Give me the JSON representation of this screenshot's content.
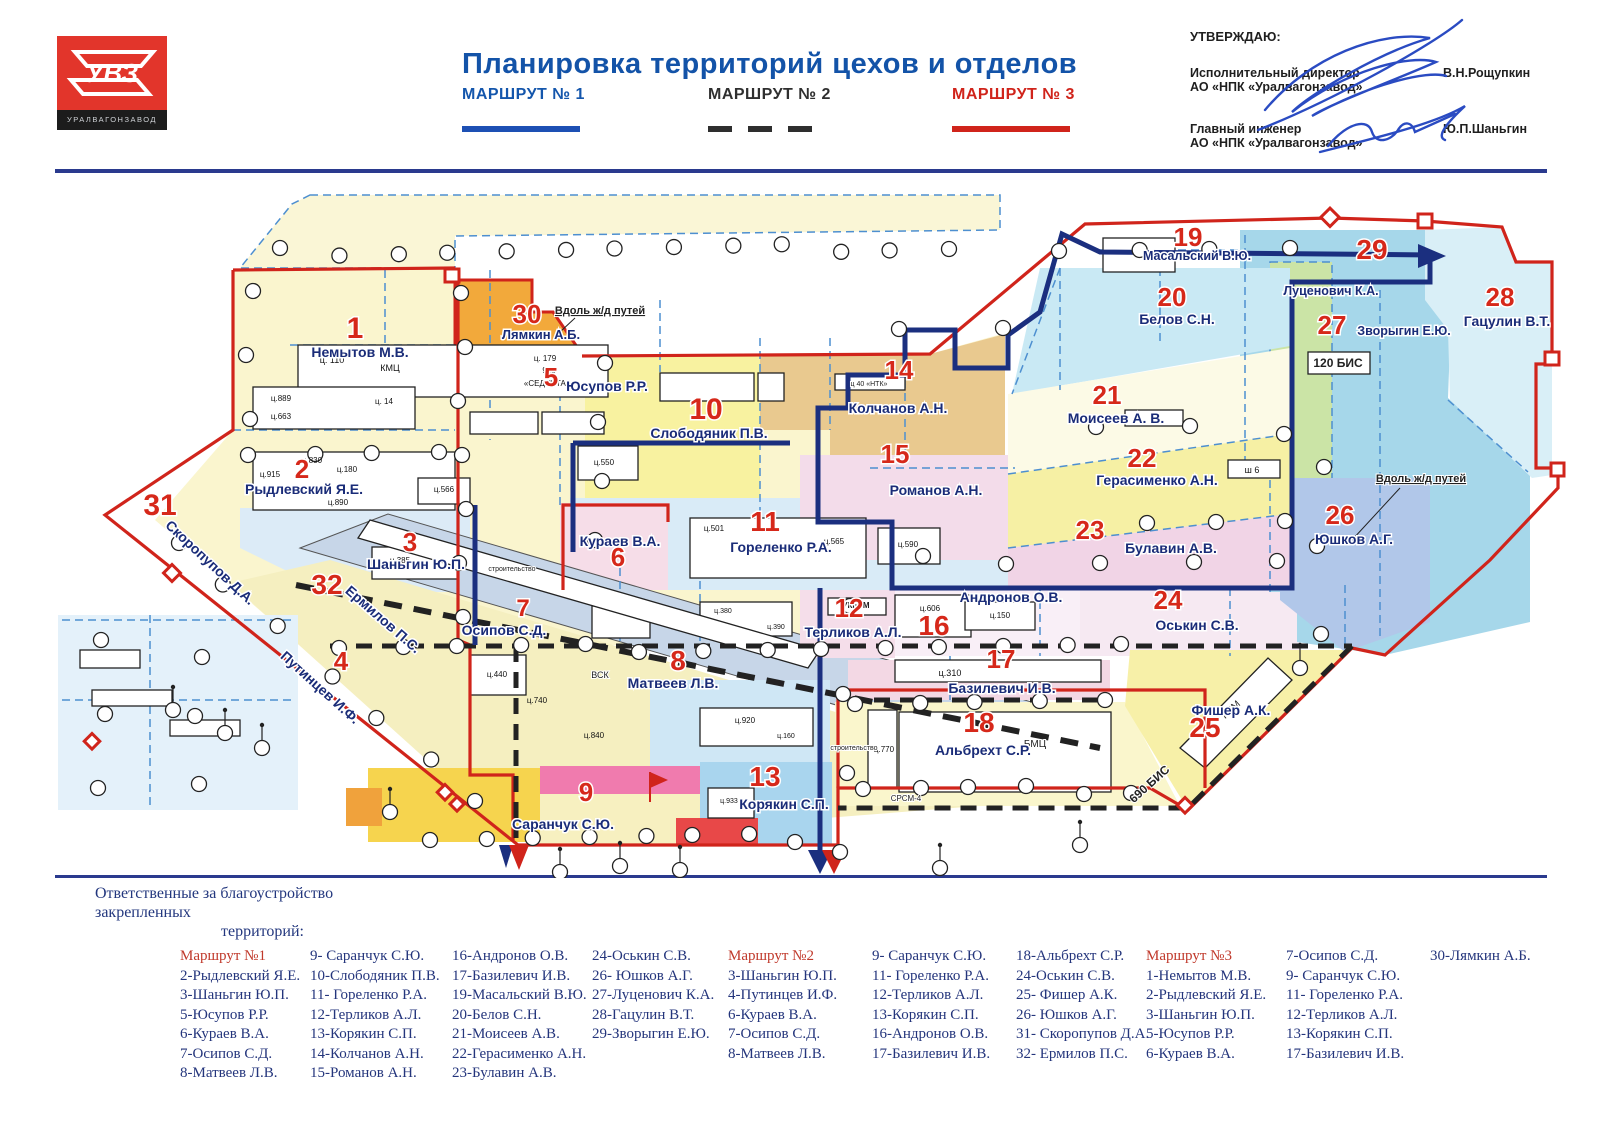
{
  "header": {
    "logo_text": "УВЗ",
    "logo_subtext": "УРАЛВАГОНЗАВОД",
    "title": "Планировка территорий цехов и отделов",
    "routes": [
      {
        "label": "МАРШРУТ № 1",
        "color": "#1456ac",
        "style": "solid-blue"
      },
      {
        "label": "МАРШРУТ № 2",
        "color": "#2f2f2f",
        "style": "dashed-black"
      },
      {
        "label": "МАРШРУТ № 3",
        "color": "#d0241b",
        "style": "solid-red"
      }
    ],
    "approval": {
      "approve_label": "УТВЕРЖДАЮ:",
      "signers": [
        {
          "role_line1": "Исполнительный директор",
          "role_line2": "АО «НПК «Уралвагонзавод»",
          "name": "В.Н.Рощупкин"
        },
        {
          "role_line1": "Главный инженер",
          "role_line2": "АО «НПК «Уралвагонзавод»",
          "name": "Ю.П.Шаньгин"
        }
      ]
    }
  },
  "map": {
    "zones": [
      {
        "num": "1",
        "name": "Немытов М.В."
      },
      {
        "num": "2",
        "name": "Рыдлевский Я.Е."
      },
      {
        "num": "3",
        "name": "Шаньгин Ю.П."
      },
      {
        "num": "4",
        "name": "Путинцев И.Ф."
      },
      {
        "num": "5",
        "name": "Юсупов Р.Р."
      },
      {
        "num": "6",
        "name": "Кураев В.А."
      },
      {
        "num": "7",
        "name": "Осипов С.Д."
      },
      {
        "num": "8",
        "name": "Матвеев Л.В."
      },
      {
        "num": "9",
        "name": "Саранчук С.Ю."
      },
      {
        "num": "10",
        "name": "Слободяник П.В."
      },
      {
        "num": "11",
        "name": "Гореленко Р.А."
      },
      {
        "num": "12",
        "name": "Терликов А.Л."
      },
      {
        "num": "13",
        "name": "Корякин С.П."
      },
      {
        "num": "14",
        "name": "Колчанов А.Н."
      },
      {
        "num": "15",
        "name": "Романов А.Н."
      },
      {
        "num": "16",
        "name": "Андронов О.В."
      },
      {
        "num": "17",
        "name": "Базилевич И.В."
      },
      {
        "num": "18",
        "name": "Альбрехт С.Р."
      },
      {
        "num": "19",
        "name": "Масальский В.Ю."
      },
      {
        "num": "20",
        "name": "Белов С.Н."
      },
      {
        "num": "21",
        "name": "Моисеев А. В."
      },
      {
        "num": "22",
        "name": "Герасименко А.Н."
      },
      {
        "num": "23",
        "name": "Булавин А.В."
      },
      {
        "num": "24",
        "name": "Оськин С.В."
      },
      {
        "num": "25",
        "name": "Фишер А.К."
      },
      {
        "num": "26",
        "name": "Юшков А.Г."
      },
      {
        "num": "27",
        "name": "Луценович К.А."
      },
      {
        "num": "28",
        "name": "Гацулин В.Т."
      },
      {
        "num": "29",
        "name": "Зворыгин Е.Ю."
      },
      {
        "num": "30",
        "name": "Лямкин А.Б."
      },
      {
        "num": "31",
        "name": "Скоропупов Д.А."
      },
      {
        "num": "32",
        "name": "Ермилов П.С."
      }
    ],
    "annotations": [
      {
        "id": "rail1",
        "label": "Вдоль ж/д путей"
      },
      {
        "id": "rail2",
        "label": "Вдоль ж/д путей"
      },
      {
        "id": "bis120",
        "label": "120 БИС"
      },
      {
        "id": "bis690",
        "label": "690 БИС"
      },
      {
        "id": "srsm",
        "label": "СРСМ-4"
      },
      {
        "id": "stroy1",
        "label": "строительство"
      },
      {
        "id": "stroy2",
        "label": "строительство"
      },
      {
        "id": "vsk",
        "label": "ВСК"
      },
      {
        "id": "bmc",
        "label": "БМЦ"
      },
      {
        "id": "kim",
        "label": "КИМ"
      },
      {
        "id": "ukbtm",
        "label": "УКБТМ"
      },
      {
        "id": "ntk",
        "label": "ц 40 «НТК»"
      }
    ],
    "buildings": [
      {
        "id": "b110",
        "label": "ц. 110"
      },
      {
        "id": "bkmc",
        "label": "КМЦ"
      },
      {
        "id": "b179",
        "label": "ц. 179"
      },
      {
        "id": "b915s",
        "label": "915"
      },
      {
        "id": "bsed",
        "label": "«СЕДУНТАГ»"
      },
      {
        "id": "b889",
        "label": "ц.889"
      },
      {
        "id": "b663",
        "label": "ц.663"
      },
      {
        "id": "b14",
        "label": "ц. 14"
      },
      {
        "id": "b915",
        "label": "ц.915"
      },
      {
        "id": "b830",
        "label": "ц.830"
      },
      {
        "id": "b180",
        "label": "ц.180"
      },
      {
        "id": "b890",
        "label": "ц.890"
      },
      {
        "id": "b566",
        "label": "ц.566"
      },
      {
        "id": "b385",
        "label": "ц.385"
      },
      {
        "id": "b550",
        "label": "ц.550"
      },
      {
        "id": "b501",
        "label": "ц.501"
      },
      {
        "id": "b565",
        "label": "ц.565"
      },
      {
        "id": "b590",
        "label": "ц.590"
      },
      {
        "id": "b606",
        "label": "ц.606"
      },
      {
        "id": "b150",
        "label": "ц.150"
      },
      {
        "id": "b310",
        "label": "ц.310"
      },
      {
        "id": "b770",
        "label": "ц.770"
      },
      {
        "id": "b933",
        "label": "ц.933"
      },
      {
        "id": "b440",
        "label": "ц.440"
      },
      {
        "id": "b740",
        "label": "ц.740"
      },
      {
        "id": "b840",
        "label": "ц.840"
      },
      {
        "id": "b920",
        "label": "ц.920"
      },
      {
        "id": "b160",
        "label": "ц.160"
      },
      {
        "id": "b380",
        "label": "ц.380"
      },
      {
        "id": "b390",
        "label": "ц.390"
      },
      {
        "id": "bsh6",
        "label": "ш 6"
      }
    ]
  },
  "footer": {
    "title_line1": "Ответственные за благоустройство закрепленных",
    "title_line2": "территорий:",
    "groups": [
      {
        "header": "Маршрут №1",
        "columns": [
          [
            "2-Рыдлевский Я.Е.",
            "3-Шаньгин Ю.П.",
            "5-Юсупов Р.Р.",
            "6-Кураев В.А.",
            "7-Осипов С.Д.",
            "8-Матвеев Л.В."
          ],
          [
            "9- Саранчук С.Ю.",
            "10-Слободяник П.В.",
            "11- Гореленко Р.А.",
            "12-Терликов А.Л.",
            "13-Корякин С.П.",
            "14-Колчанов А.Н.",
            "15-Романов А.Н."
          ],
          [
            "16-Андронов О.В.",
            "17-Базилевич И.В.",
            "19-Масальский В.Ю.",
            "20-Белов С.Н.",
            "21-Моисеев А.В.",
            "22-Герасименко А.Н.",
            "23-Булавин А.В."
          ],
          [
            "24-Оськин С.В.",
            "26- Юшков А.Г.",
            "27-Луценович К.А.",
            "28-Гацулин В.Т.",
            "29-Зворыгин Е.Ю."
          ]
        ]
      },
      {
        "header": "Маршрут №2",
        "columns": [
          [
            "3-Шаньгин Ю.П.",
            "4-Путинцев И.Ф.",
            "6-Кураев В.А.",
            "7-Осипов С.Д.",
            "8-Матвеев Л.В."
          ],
          [
            "9- Саранчук С.Ю.",
            "11- Гореленко Р.А.",
            "12-Терликов А.Л.",
            "13-Корякин С.П.",
            "16-Андронов О.В.",
            "17-Базилевич И.В."
          ],
          [
            "18-Альбрехт С.Р.",
            "24-Оськин С.В.",
            "25- Фишер А.К.",
            "26- Юшков А.Г.",
            "31- Скоропупов Д.А.",
            "32- Ермилов П.С."
          ]
        ]
      },
      {
        "header": "Маршрут №3",
        "columns": [
          [
            "1-Немытов М.В.",
            "2-Рыдлевский Я.Е.",
            "3-Шаньгин Ю.П.",
            "5-Юсупов Р.Р.",
            "6-Кураев В.А."
          ],
          [
            "7-Осипов С.Д.",
            "9- Саранчук С.Ю.",
            "11- Гореленко Р.А.",
            "12-Терликов А.Л.",
            "13-Корякин С.П.",
            "17-Базилевич И.В."
          ],
          [
            "30-Лямкин А.Б."
          ]
        ]
      }
    ]
  }
}
